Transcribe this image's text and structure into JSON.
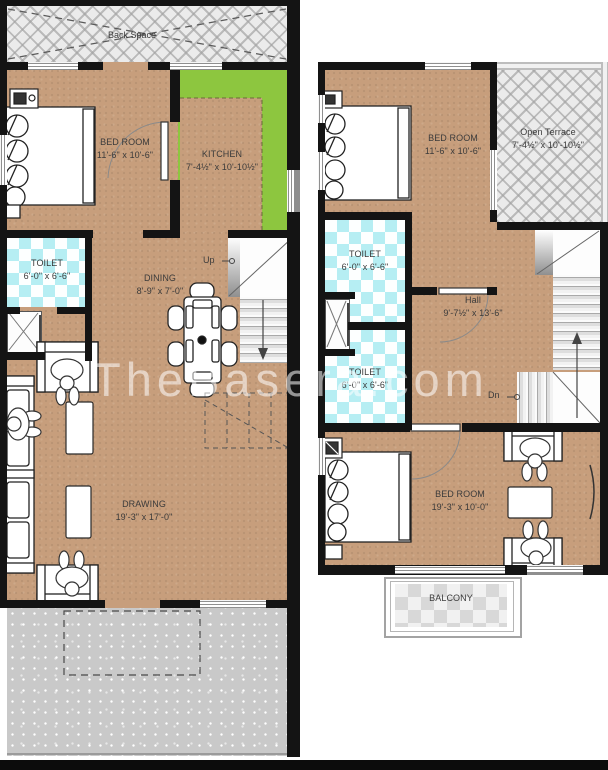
{
  "watermark": "TheBasera.com",
  "colors": {
    "floor_tan": "#c79e7c",
    "kitchen_green": "#8dc63f",
    "toilet_cyan": "#b6eef3",
    "wall": "#141414",
    "hatch_gray": "#ebebeb"
  },
  "ground_floor": {
    "back_space_label": "Back Space",
    "stairs_label": "Up",
    "rooms": {
      "bed": {
        "name": "BED ROOM",
        "dims": "11'-6\" x 10'-6\""
      },
      "kitchen": {
        "name": "KITCHEN",
        "dims": "7'-4½\" x 10'-10½\""
      },
      "toilet": {
        "name": "TOILET",
        "dims": "6'-0\" x 6'-6\""
      },
      "dining": {
        "name": "DINING",
        "dims": "8'-9\" x 7'-0\""
      },
      "drawing": {
        "name": "DRAWING",
        "dims": "19'-3\" x 17'-0\""
      }
    }
  },
  "first_floor": {
    "stairs_label": "Dn",
    "rooms": {
      "bed": {
        "name": "BED ROOM",
        "dims": "11'-6\" x 10'-6\""
      },
      "terrace": {
        "name": "Open Terrace",
        "dims": "7'-4½\" x 10'-10½\""
      },
      "toilet_upper": {
        "name": "TOILET",
        "dims": "6'-0\" x 6'-6\""
      },
      "toilet_lower": {
        "name": "TOILET",
        "dims": "6'-0\" x 6'-6\""
      },
      "hall": {
        "name": "Hall",
        "dims": "9'-7½\" x 13'-6\""
      },
      "bed_lower": {
        "name": "BED ROOM",
        "dims": "19'-3\" x 10'-0\""
      },
      "balcony_label": "BALCONY"
    }
  }
}
